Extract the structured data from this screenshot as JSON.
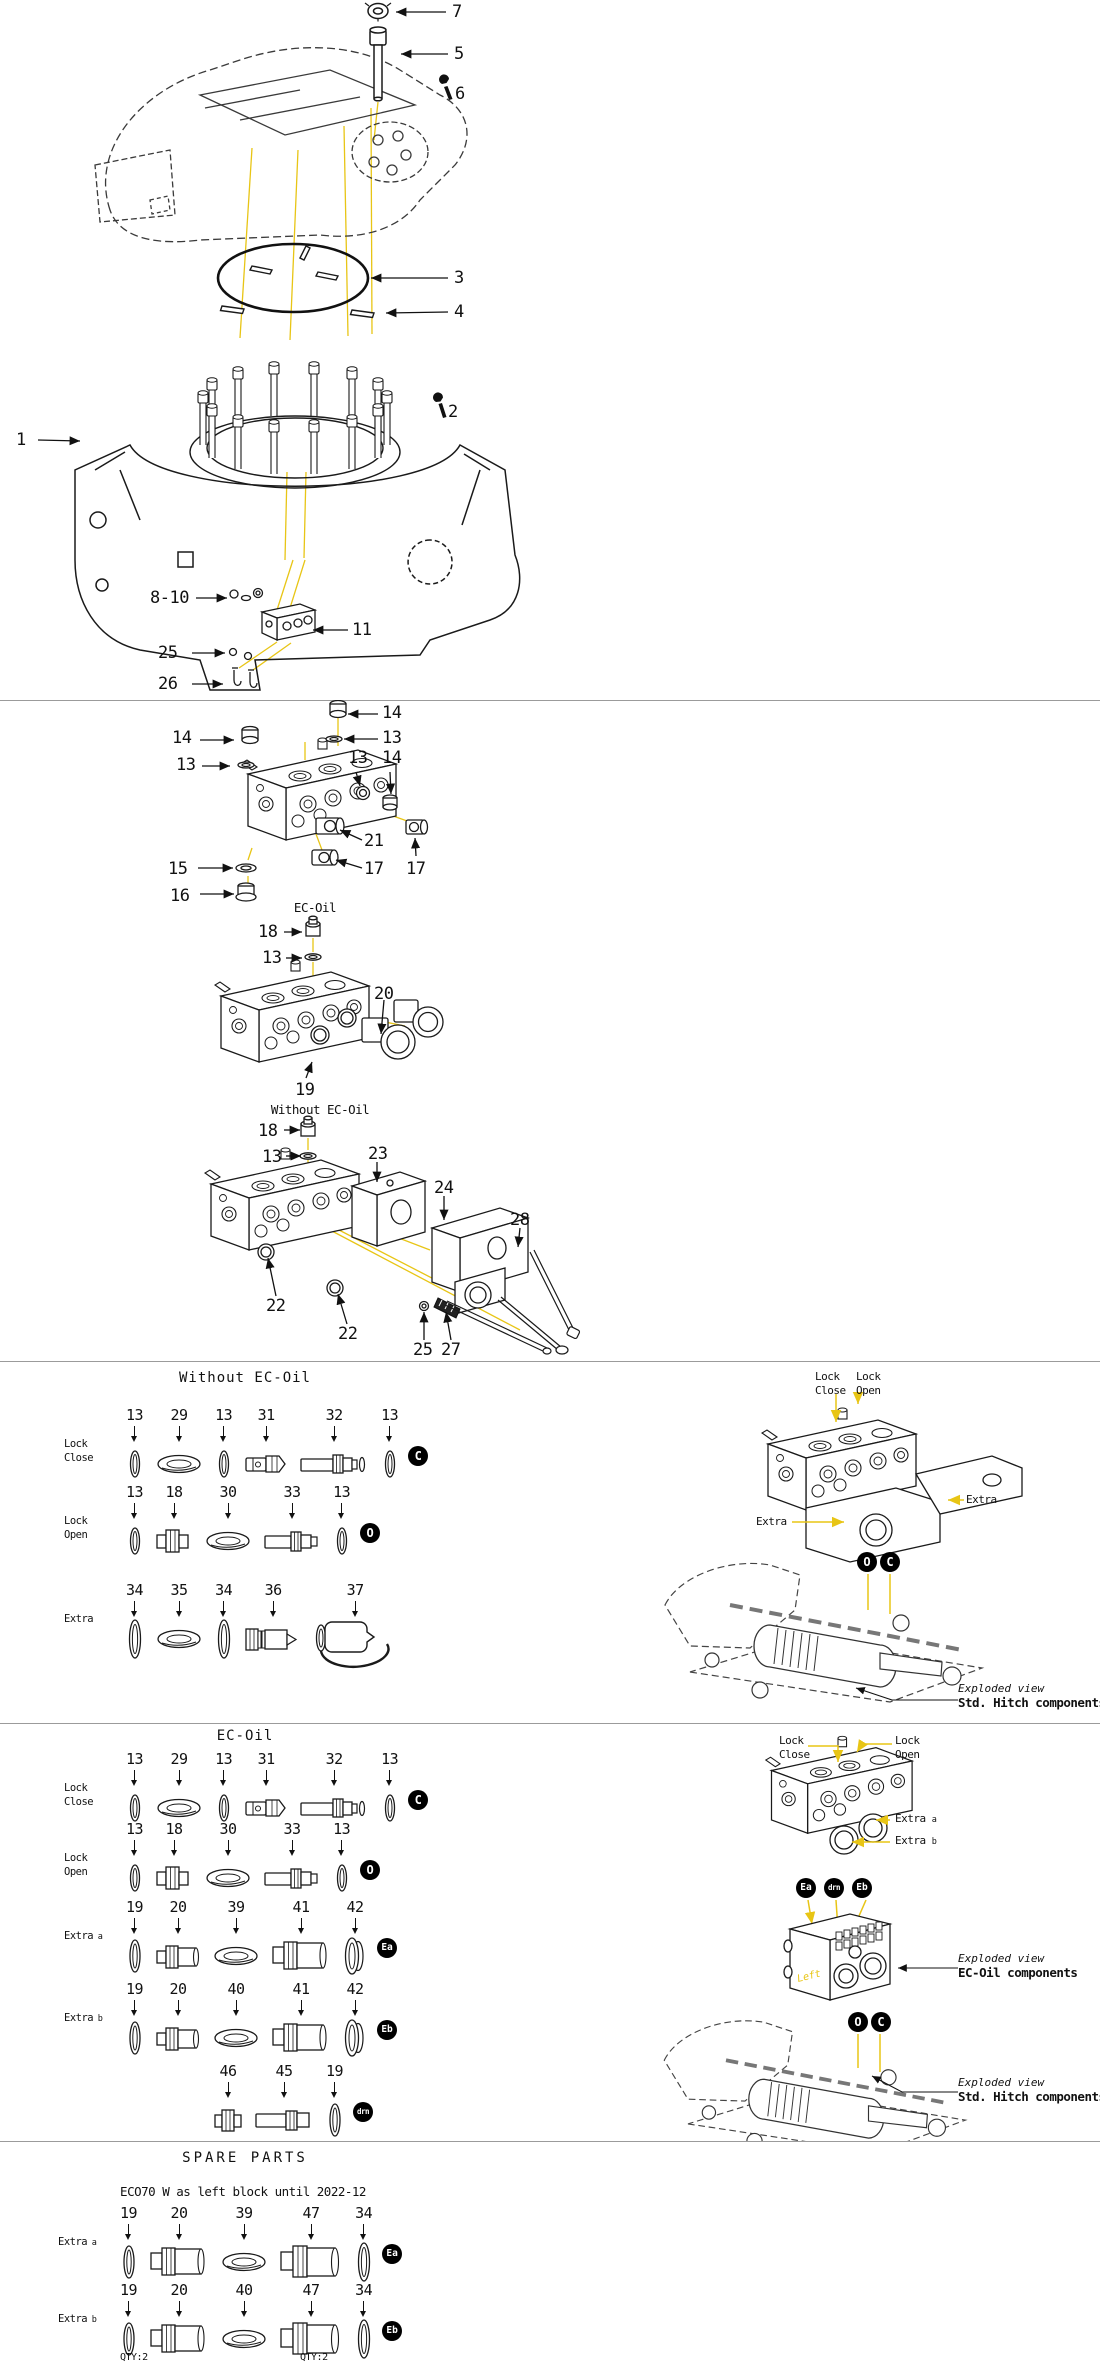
{
  "meta": {
    "accent": "#e8c515",
    "line": "#1a1a1a",
    "badge_bg": "#000000",
    "badge_fg": "#ffffff"
  },
  "s1": {
    "callouts": [
      "7",
      "5",
      "6",
      "3",
      "4",
      "2",
      "1",
      "8-10",
      "11",
      "25",
      "26"
    ]
  },
  "s2": {
    "block_callouts": [
      "14",
      "13",
      "14",
      "13",
      "13",
      "14",
      "21",
      "17",
      "17",
      "15",
      "16"
    ],
    "ecoil_title": "EC-Oil",
    "ecoil_callouts": [
      "18",
      "13",
      "20",
      "19"
    ],
    "without_title": "Without EC-Oil",
    "without_callouts": [
      "18",
      "13",
      "23",
      "24",
      "28",
      "22",
      "22",
      "25",
      "27"
    ]
  },
  "s3": {
    "title": "Without EC-Oil",
    "rows": [
      {
        "label": "Lock",
        "label2": "Close",
        "sub": "",
        "badge": "C",
        "parts": [
          {
            "num": "13",
            "icon": "oring-s"
          },
          {
            "num": "29",
            "icon": "seal"
          },
          {
            "num": "13",
            "icon": "oring-s"
          },
          {
            "num": "31",
            "icon": "plug"
          },
          {
            "num": "32",
            "icon": "valve-long"
          },
          {
            "num": "13",
            "icon": "oring-s"
          }
        ]
      },
      {
        "label": "Lock",
        "label2": "Open",
        "sub": "",
        "badge": "O",
        "parts": [
          {
            "num": "13",
            "icon": "oring-s"
          },
          {
            "num": "18",
            "icon": "fitting"
          },
          {
            "num": "30",
            "icon": "seal"
          },
          {
            "num": "33",
            "icon": "valve-med"
          },
          {
            "num": "13",
            "icon": "oring-s"
          }
        ]
      },
      {
        "label": "Extra",
        "label2": "",
        "sub": "",
        "badge": "",
        "parts": [
          {
            "num": "34",
            "icon": "oring-t"
          },
          {
            "num": "35",
            "icon": "seal"
          },
          {
            "num": "34",
            "icon": "oring-t"
          },
          {
            "num": "36",
            "icon": "coupler-cone"
          },
          {
            "num": "37",
            "icon": "cap-strap"
          }
        ]
      }
    ],
    "diagram": {
      "lock_close": "Lock",
      "lock_close2": "Close",
      "lock_open": "Lock",
      "lock_open2": "Open",
      "extra_right": "Extra",
      "extra_left": "Extra"
    },
    "badge_o": "O",
    "badge_c": "C",
    "caption1": "Exploded view",
    "caption2": "Std. Hitch components"
  },
  "s4": {
    "title": "EC-Oil",
    "rows": [
      {
        "label": "Lock",
        "label2": "Close",
        "sub": "",
        "badge": "C",
        "parts": [
          {
            "num": "13",
            "icon": "oring-s"
          },
          {
            "num": "29",
            "icon": "seal"
          },
          {
            "num": "13",
            "icon": "oring-s"
          },
          {
            "num": "31",
            "icon": "plug"
          },
          {
            "num": "32",
            "icon": "valve-long"
          },
          {
            "num": "13",
            "icon": "oring-s"
          }
        ]
      },
      {
        "label": "Lock",
        "label2": "Open",
        "sub": "",
        "badge": "O",
        "parts": [
          {
            "num": "13",
            "icon": "oring-s"
          },
          {
            "num": "18",
            "icon": "fitting"
          },
          {
            "num": "30",
            "icon": "seal"
          },
          {
            "num": "33",
            "icon": "valve-med"
          },
          {
            "num": "13",
            "icon": "oring-s"
          }
        ]
      },
      {
        "label": "Extra",
        "label2": "",
        "sub": "a",
        "badge": "Ea",
        "parts": [
          {
            "num": "19",
            "icon": "oring-m"
          },
          {
            "num": "20",
            "icon": "coupler-s"
          },
          {
            "num": "39",
            "icon": "seal"
          },
          {
            "num": "41",
            "icon": "coupler-l"
          },
          {
            "num": "42",
            "icon": "flange"
          }
        ]
      },
      {
        "label": "Extra",
        "label2": "",
        "sub": "b",
        "badge": "Eb",
        "parts": [
          {
            "num": "19",
            "icon": "oring-m"
          },
          {
            "num": "20",
            "icon": "coupler-s"
          },
          {
            "num": "40",
            "icon": "seal"
          },
          {
            "num": "41",
            "icon": "coupler-l"
          },
          {
            "num": "42",
            "icon": "flange"
          }
        ]
      },
      {
        "label": "",
        "label2": "",
        "sub": "",
        "badge": "drn",
        "parts": [
          {
            "num": "46",
            "icon": "fitting-s"
          },
          {
            "num": "45",
            "icon": "valve-45"
          },
          {
            "num": "19",
            "icon": "oring-m"
          }
        ]
      }
    ],
    "diagram": {
      "lock_close": "Lock",
      "lock_close2": "Close",
      "lock_open": "Lock",
      "lock_open2": "Open",
      "extra_a": "Extra",
      "extra_a_sub": "a",
      "extra_b": "Extra",
      "extra_b_sub": "b",
      "left_mark": "Left"
    },
    "badges_mid": [
      "Ea",
      "drn",
      "Eb"
    ],
    "badge_o": "O",
    "badge_c": "C",
    "caption_ec1": "Exploded view",
    "caption_ec2": "EC-Oil components",
    "caption_hitch1": "Exploded view",
    "caption_hitch2": "Std. Hitch components"
  },
  "s5": {
    "title": "SPARE PARTS",
    "subtitle": "ECO70 W as left block until 2022-12",
    "rows": [
      {
        "label": "Extra",
        "label2": "",
        "sub": "a",
        "badge": "Ea",
        "parts": [
          {
            "num": "19",
            "icon": "oring-m"
          },
          {
            "num": "20",
            "icon": "coupler-l"
          },
          {
            "num": "39",
            "icon": "seal"
          },
          {
            "num": "47",
            "icon": "coupler-xl"
          },
          {
            "num": "34",
            "icon": "oring-t"
          }
        ]
      },
      {
        "label": "Extra",
        "label2": "",
        "sub": "b",
        "badge": "Eb",
        "parts": [
          {
            "num": "19",
            "icon": "oring-m"
          },
          {
            "num": "20",
            "icon": "coupler-l"
          },
          {
            "num": "40",
            "icon": "seal"
          },
          {
            "num": "47",
            "icon": "coupler-xl"
          },
          {
            "num": "34",
            "icon": "oring-t"
          }
        ]
      }
    ],
    "qty_left": "QTY:2",
    "qty_right": "QTY:2"
  }
}
